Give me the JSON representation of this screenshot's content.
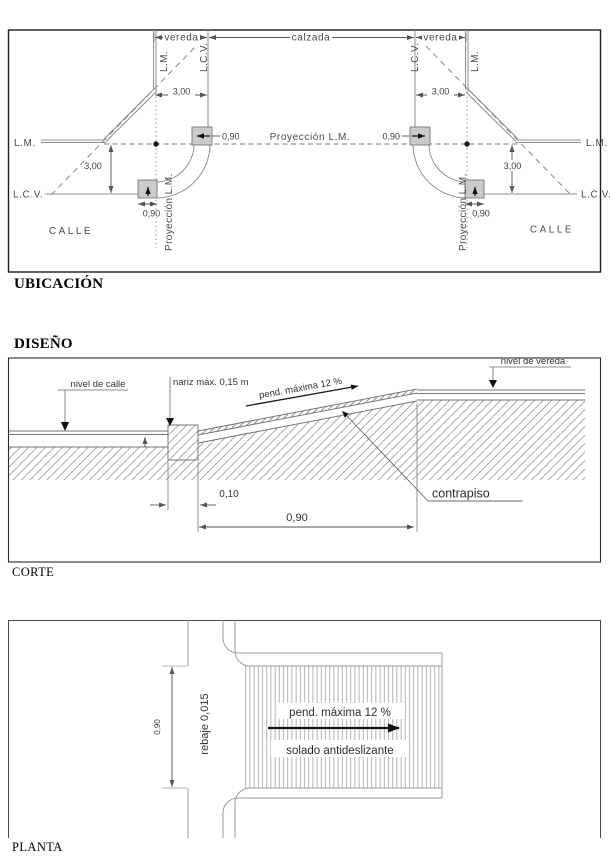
{
  "ubicacion": {
    "heading": "UBICACIÓN",
    "vereda": "vereda",
    "calzada": "calzada",
    "lm": "L.M.",
    "lcv": "L.C.V.",
    "proyeccion_lm": "Proyección L.M.",
    "calle": "CALLE",
    "dim_300": "3,00",
    "dim_090": "0,90"
  },
  "diseno": {
    "heading": "DISEÑO",
    "caption": "CORTE",
    "nivel_de_calle": "nivel de calle",
    "nariz": "nariz máx. 0,15 m",
    "pend_maxima": "pend. máxima 12 %",
    "nivel_de_vereda": "nivel de vereda",
    "contrapiso": "contrapiso",
    "dim_010": "0,10",
    "dim_090": "0,90"
  },
  "planta": {
    "caption": "PLANTA",
    "dim_090": "0,90",
    "rebaje": "rebaje 0,015",
    "pend_maxima": "pend. máxima 12 %",
    "solado": "solado antideslizante"
  }
}
